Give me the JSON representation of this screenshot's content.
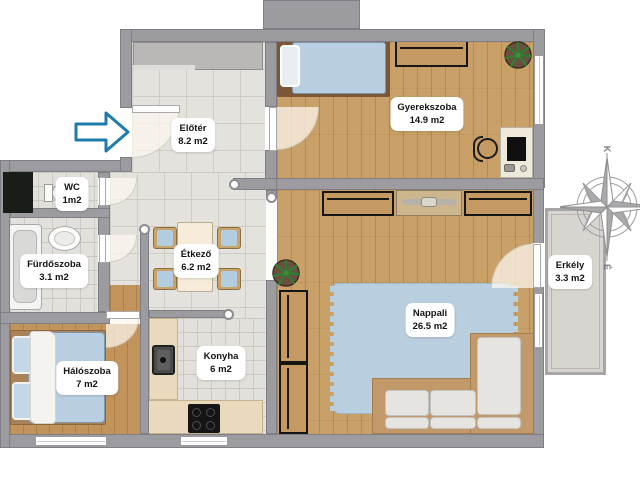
{
  "floorplan": {
    "title": "Apartment floor plan",
    "rooms": [
      {
        "id": "eloter",
        "name": "Előtér",
        "area": "8.2 m2"
      },
      {
        "id": "wc",
        "name": "WC",
        "area": "1m2"
      },
      {
        "id": "furdoszoba",
        "name": "Fürdőszoba",
        "area": "3.1 m2"
      },
      {
        "id": "haloszoba",
        "name": "Hálószoba",
        "area": "7 m2"
      },
      {
        "id": "etkezo",
        "name": "Étkező",
        "area": "6.2 m2"
      },
      {
        "id": "konyha",
        "name": "Konyha",
        "area": "6 m2"
      },
      {
        "id": "gyerekszoba",
        "name": "Gyerekszoba",
        "area": "14.9 m2"
      },
      {
        "id": "nappali",
        "name": "Nappali",
        "area": "26.5 m2"
      },
      {
        "id": "erkely",
        "name": "Erkély",
        "area": "3.3 m2"
      }
    ],
    "compass": {
      "top_letter": "K",
      "bottom_letter": "É"
    },
    "icons": {
      "entrance_arrow": "right-pointing outlined arrow marking the flat entrance",
      "compass_rose": "8-point compass rose",
      "plant": "potted plant"
    },
    "colors": {
      "wall": "#9c9ca0",
      "wood_floor": "#c9a168",
      "tile_floor": "#e4e2dd",
      "rug_blue": "#b9cfe0",
      "bed_blue": "#b7cfe1",
      "arrow_blue": "#1e7bad",
      "cabinet_wood": "#c49a62",
      "balcony_floor": "#d8d5d0"
    }
  }
}
